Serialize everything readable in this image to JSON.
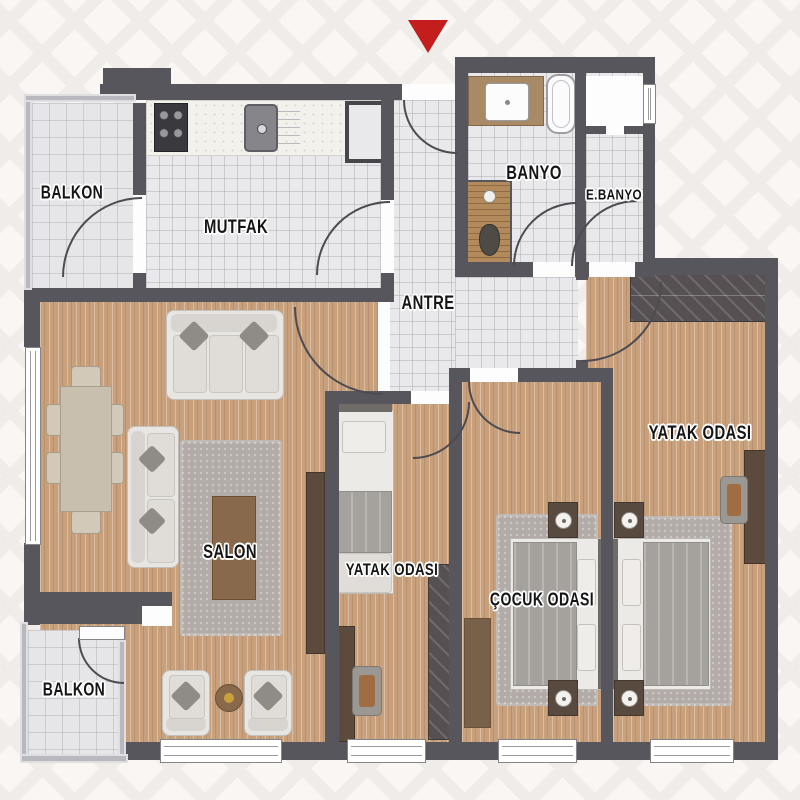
{
  "plan": {
    "rooms": [
      {
        "id": "balkon-ust",
        "label": "BALKON"
      },
      {
        "id": "mutfak",
        "label": "MUTFAK"
      },
      {
        "id": "banyo",
        "label": "BANYO"
      },
      {
        "id": "ebanyo",
        "label": "E.BANYO"
      },
      {
        "id": "antre",
        "label": "ANTRE"
      },
      {
        "id": "salon",
        "label": "SALON"
      },
      {
        "id": "yatak-odasi-1",
        "label": "YATAK ODASI"
      },
      {
        "id": "cocuk-odasi",
        "label": "ÇOCUK ODASI"
      },
      {
        "id": "yatak-odasi-2",
        "label": "YATAK ODASI"
      },
      {
        "id": "balkon-alt",
        "label": "BALKON"
      }
    ],
    "colors": {
      "wall": "#57565c",
      "wood_floor": "#c9a07c",
      "tile_floor": "#e9e9eb",
      "rug": "#b2aba7",
      "north_marker": "#c41d1d"
    }
  }
}
